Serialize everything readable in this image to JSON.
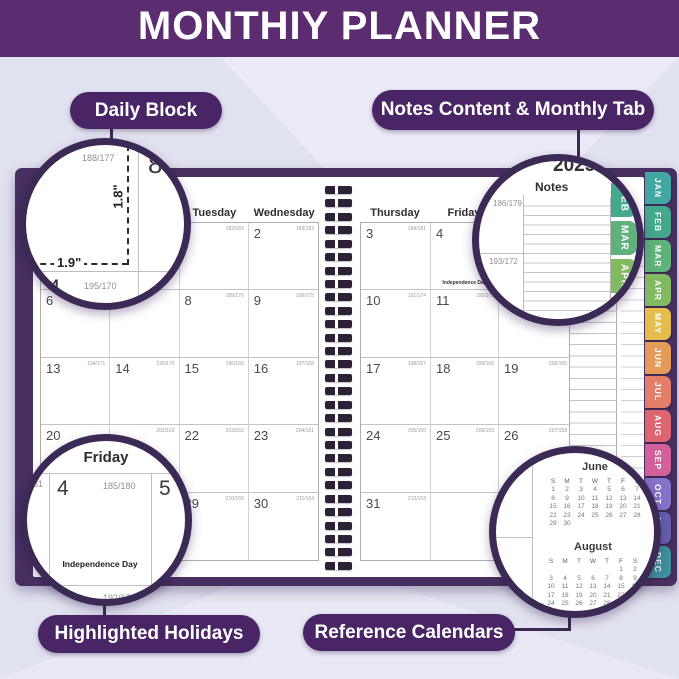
{
  "header": {
    "title": "MONTHIY PLANNER"
  },
  "callouts": {
    "daily_block": "Daily Block",
    "notes_monthly": "Notes Content & Monthly Tab",
    "holidays": "Highlighted Holidays",
    "reference": "Reference Calendars"
  },
  "colors": {
    "header_bar": "#5B2C70",
    "pill": "#4A2566",
    "cover": "#473061",
    "magnifier_ring": "#3B2A55",
    "background": "#E1E2EF"
  },
  "planner": {
    "left": {
      "headers": [
        "",
        "",
        "Tuesday",
        "Wednesday"
      ],
      "cells": [
        [
          null,
          null,
          {
            "day": "",
            "doy": "182/183"
          },
          {
            "day": "2",
            "doy": "183/182"
          }
        ],
        [
          {
            "day": "6",
            "doy": ""
          },
          null,
          {
            "day": "8",
            "doy": "189/176"
          },
          {
            "day": "9",
            "doy": "190/175"
          }
        ],
        [
          {
            "day": "13",
            "doy": "194/171"
          },
          {
            "day": "14",
            "doy": "195/170"
          },
          {
            "day": "15",
            "doy": "196/169"
          },
          {
            "day": "16",
            "doy": "197/168"
          }
        ],
        [
          {
            "day": "20",
            "doy": ""
          },
          {
            "day": "",
            "doy": "202/163"
          },
          {
            "day": "22",
            "doy": "203/162"
          },
          {
            "day": "23",
            "doy": "204/161"
          }
        ],
        [
          null,
          null,
          {
            "day": "29",
            "doy": "210/155"
          },
          {
            "day": "30",
            "doy": "211/154"
          }
        ]
      ]
    },
    "right": {
      "headers": [
        "Thursday",
        "Friday",
        ""
      ],
      "cells": [
        [
          {
            "day": "3",
            "doy": "184/181"
          },
          {
            "day": "4",
            "doy": "",
            "holiday": "Independence Day"
          },
          null
        ],
        [
          {
            "day": "10",
            "doy": "191/174"
          },
          {
            "day": "11",
            "doy": "192/173"
          },
          null
        ],
        [
          {
            "day": "17",
            "doy": "198/167"
          },
          {
            "day": "18",
            "doy": "199/166"
          },
          {
            "day": "19",
            "doy": "200/165"
          }
        ],
        [
          {
            "day": "24",
            "doy": "205/160"
          },
          {
            "day": "25",
            "doy": "206/159"
          },
          {
            "day": "26",
            "doy": "207/158"
          }
        ],
        [
          {
            "day": "31",
            "doy": "212/153"
          },
          {
            "day": "",
            "doy": ""
          },
          null
        ]
      ]
    },
    "tabs": [
      {
        "label": "JAN",
        "color": "#41A7A3"
      },
      {
        "label": "FEB",
        "color": "#44A98C"
      },
      {
        "label": "MAR",
        "color": "#5FB27B"
      },
      {
        "label": "APR",
        "color": "#82BA62"
      },
      {
        "label": "MAY",
        "color": "#E4BD4D"
      },
      {
        "label": "JUN",
        "color": "#E59B58"
      },
      {
        "label": "JUL",
        "color": "#E37E68"
      },
      {
        "label": "AUG",
        "color": "#DD6571"
      },
      {
        "label": "SEP",
        "color": "#D2619B"
      },
      {
        "label": "OCT",
        "color": "#8473C8"
      },
      {
        "label": "NOV",
        "color": "#655FAE"
      },
      {
        "label": "DEC",
        "color": "#3F8F9D"
      }
    ]
  },
  "magnifiers": {
    "daily_block": {
      "day_top": "7",
      "doy_top": "188/177",
      "day_right": "8",
      "height_label": "1.8\"",
      "width_label": "1.9\"",
      "day_bottom": "14",
      "doy_bottom": "195/170"
    },
    "notes_tab": {
      "year": "2025",
      "header_partial": "ay",
      "notes_header": "Notes",
      "doy_top": "186/179",
      "doy_bottom": "193/172",
      "tabs": [
        {
          "label": "FEB",
          "color": "#44A98C"
        },
        {
          "label": "MAR",
          "color": "#5FB27B"
        },
        {
          "label": "APR",
          "color": "#82BA62"
        },
        {
          "label": "",
          "color": "#E4BD4D"
        }
      ]
    },
    "holidays": {
      "header": "Friday",
      "doy_partial": "181",
      "day": "4",
      "doy": "185/180",
      "day_next": "5",
      "holiday": "Independence Day",
      "day_below": "11",
      "doy_below": "192/173",
      "day_below_next": "12"
    },
    "reference": {
      "june": {
        "title": "June",
        "weekdays": [
          "S",
          "M",
          "T",
          "W",
          "T",
          "F",
          "S"
        ],
        "weeks": [
          [
            "1",
            "2",
            "3",
            "4",
            "5",
            "6",
            "7"
          ],
          [
            "8",
            "9",
            "10",
            "11",
            "12",
            "13",
            "14"
          ],
          [
            "15",
            "16",
            "17",
            "18",
            "19",
            "20",
            "21"
          ],
          [
            "22",
            "23",
            "24",
            "25",
            "26",
            "27",
            "28"
          ],
          [
            "29",
            "30",
            "",
            "",
            "",
            "",
            ""
          ]
        ]
      },
      "august": {
        "title": "August",
        "weekdays": [
          "S",
          "M",
          "T",
          "W",
          "T",
          "F",
          "S"
        ],
        "weeks": [
          [
            "",
            "",
            "",
            "",
            "",
            "1",
            "2"
          ],
          [
            "3",
            "4",
            "5",
            "6",
            "7",
            "8",
            "9"
          ],
          [
            "10",
            "11",
            "12",
            "13",
            "14",
            "15",
            "16"
          ],
          [
            "17",
            "18",
            "19",
            "20",
            "21",
            "22",
            "23"
          ],
          [
            "24",
            "25",
            "26",
            "27",
            "28",
            "29",
            "30"
          ],
          [
            "31",
            "",
            "",
            "",
            "",
            "",
            ""
          ]
        ]
      }
    }
  }
}
